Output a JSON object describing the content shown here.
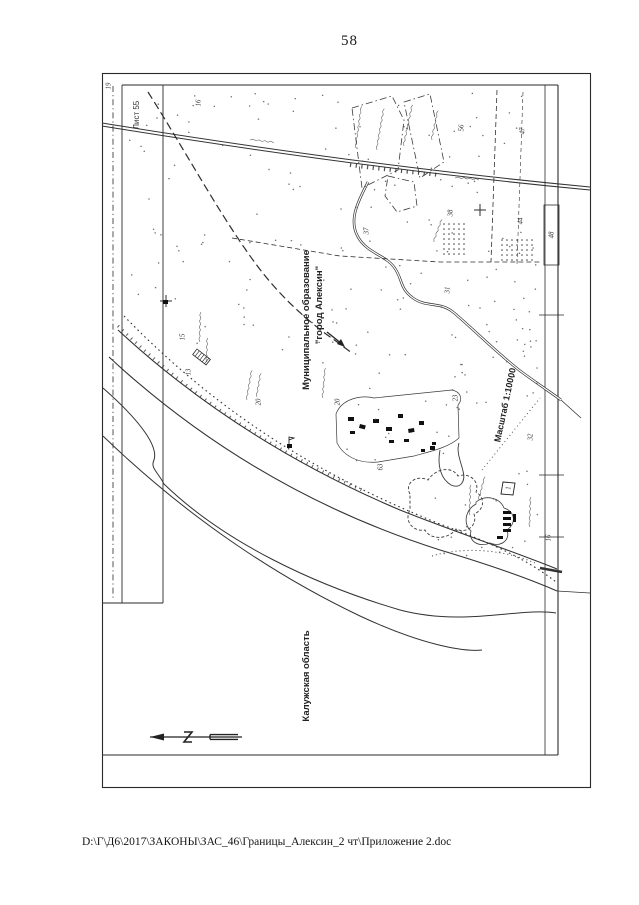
{
  "page": {
    "number": "58",
    "footer_path": "D:\\Г\\Д6\\2017\\ЗАКОНЫ\\ЗАС_46\\Границы_Алексин_2 чт\\Приложение 2.doc"
  },
  "map": {
    "labels": {
      "sheet": "Лист 55",
      "municipality_line1": "Муниципальное образование",
      "municipality_line2": "\"город Алексин\"",
      "region": "Калужская область",
      "scale": "Масштаб 1:10000"
    },
    "numbers": [
      {
        "v": "19",
        "x": 108,
        "y": 86
      },
      {
        "v": "16",
        "x": 198,
        "y": 103
      },
      {
        "v": "56",
        "x": 461,
        "y": 128
      },
      {
        "v": "47",
        "x": 522,
        "y": 131
      },
      {
        "v": "37",
        "x": 366,
        "y": 231
      },
      {
        "v": "38",
        "x": 450,
        "y": 213
      },
      {
        "v": "44",
        "x": 520,
        "y": 221
      },
      {
        "v": "48",
        "x": 551,
        "y": 235
      },
      {
        "v": "31",
        "x": 447,
        "y": 290
      },
      {
        "v": "20",
        "x": 258,
        "y": 402
      },
      {
        "v": "20",
        "x": 337,
        "y": 402
      },
      {
        "v": "23",
        "x": 455,
        "y": 398
      },
      {
        "v": "63",
        "x": 380,
        "y": 467
      },
      {
        "v": "15",
        "x": 182,
        "y": 337
      },
      {
        "v": "13",
        "x": 188,
        "y": 372
      },
      {
        "v": "32",
        "x": 530,
        "y": 437
      },
      {
        "v": "16",
        "x": 548,
        "y": 538
      },
      {
        "v": "1",
        "x": 508,
        "y": 488,
        "boxed": true
      }
    ],
    "colors": {
      "ink": "#333333",
      "frame": "#2a2a2a",
      "faint": "#555555"
    }
  }
}
